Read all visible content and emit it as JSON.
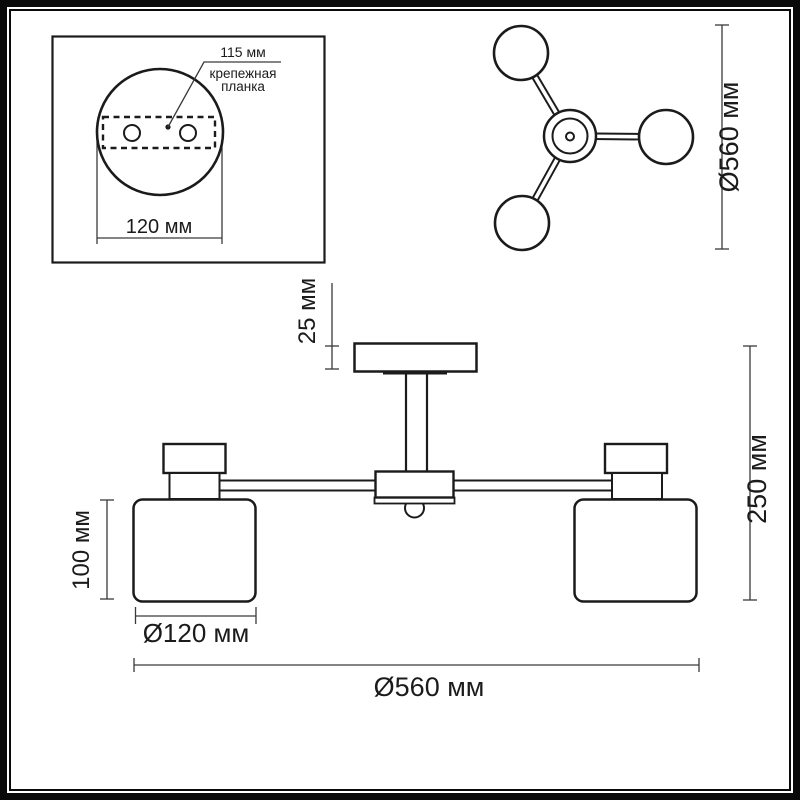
{
  "drawing_title": "chandelier-dimensions-diagram",
  "detail_view": {
    "hole_spacing_label": "115 мм",
    "part_label_line1": "крепежная",
    "part_label_line2": "планка",
    "plate_width_label": "120 мм"
  },
  "top_view": {
    "diameter_label": "Ø560 мм"
  },
  "side_view": {
    "canopy_height_label": "25 мм",
    "total_height_label": "250 мм",
    "shade_height_label": "100 мм",
    "shade_diameter_label": "Ø120 мм",
    "total_diameter_label": "Ø560 мм"
  },
  "colors": {
    "line": "#1b1b1b",
    "dimension_line": "#3a3a3a",
    "background": "#ffffff"
  }
}
